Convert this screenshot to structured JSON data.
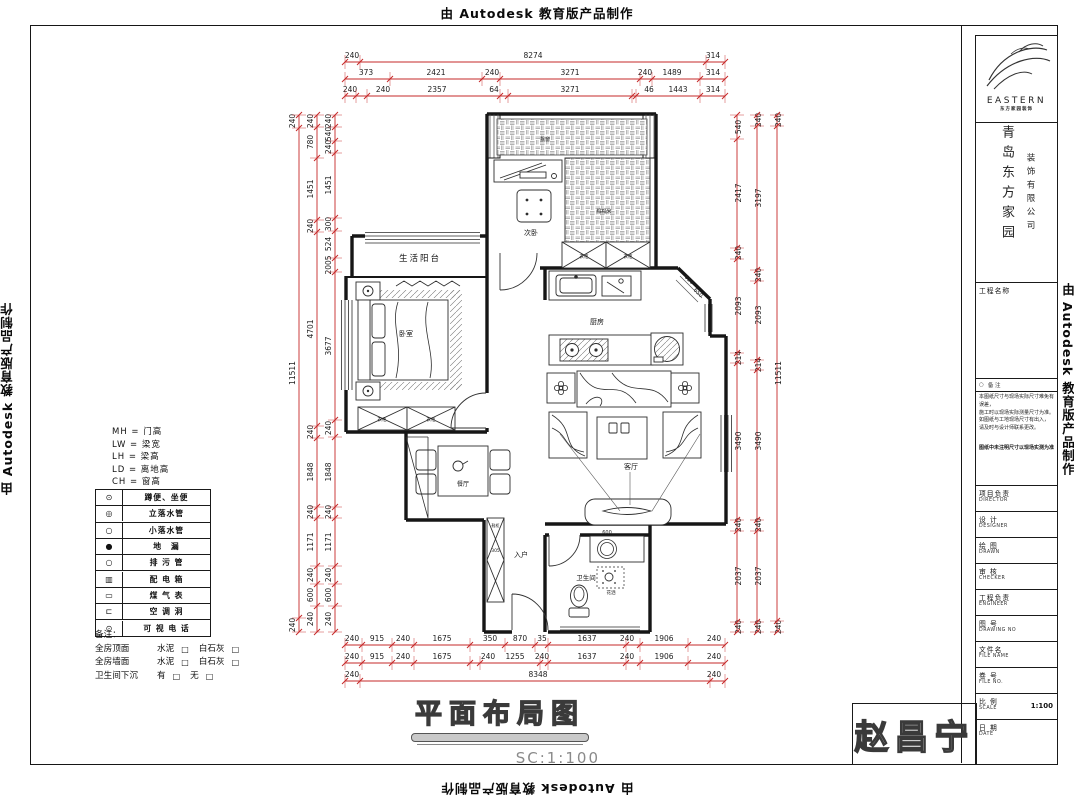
{
  "watermark": {
    "text": "由 Autodesk 教育版产品制作"
  },
  "title": {
    "main": "平面布局图",
    "scale": "SC:1:100"
  },
  "signature": "赵昌宁",
  "colors": {
    "dimension_red": "#c62828",
    "wall_black": "#161616"
  },
  "rooms": {
    "balcony": "生活阳台",
    "second_bedroom": "次卧",
    "master_bedroom": "卧室",
    "kitchen": "厨房",
    "dining": "餐厅",
    "living": "客厅",
    "entry": "入户",
    "bathroom": "卫生间",
    "tatami": "榻榻米",
    "bay_window": "飘窗"
  },
  "furniture": {
    "wardrobe": "衣柜",
    "shoe_cabinet": "鞋柜",
    "shower": "花洒"
  },
  "plan_dims": {
    "basin": "600",
    "shoe_width": "305",
    "chamfer_a": "650",
    "chamfer_b": "650"
  },
  "dims": {
    "top": [
      [
        "240",
        "8274",
        "314"
      ],
      [
        "373",
        "2421",
        "240",
        "3271",
        "240",
        "1489",
        "314"
      ],
      [
        "240",
        "240",
        "2357",
        "64",
        "3271",
        "46",
        "1443",
        "314"
      ]
    ],
    "bottom": [
      [
        "240",
        "915",
        "240",
        "1675",
        "350",
        "870",
        "35",
        "1637",
        "240",
        "1906",
        "240"
      ],
      [
        "240",
        "915",
        "240",
        "1675",
        "240",
        "1255",
        "240",
        "1637",
        "240",
        "1906",
        "240"
      ],
      [
        "240",
        "8348",
        "240"
      ]
    ],
    "left": {
      "outer": [
        "240",
        "11511",
        "240"
      ],
      "middle": [
        "240",
        "780",
        "1451",
        "240",
        "4701",
        "240",
        "1848",
        "240",
        "1171",
        "240",
        "600",
        "240"
      ],
      "inner": [
        "240",
        "540",
        "240",
        "1451",
        "300",
        "524",
        "2005",
        "3677",
        "240",
        "1848",
        "240",
        "1171",
        "240",
        "600",
        "240"
      ]
    },
    "right": {
      "inner": [
        "540",
        "2417",
        "240",
        "2093",
        "214",
        "3490",
        "240",
        "2037",
        "240"
      ],
      "middle": [
        "240",
        "3197",
        "240",
        "2093",
        "214",
        "3490",
        "240",
        "2037",
        "240"
      ],
      "outer": [
        "240",
        "11511",
        "240"
      ]
    }
  },
  "legend": {
    "abbreviations": [
      "MH = 门高",
      "LW = 梁宽",
      "LH = 梁高",
      "LD = 离地高",
      "CH = 窗高"
    ],
    "rows": [
      {
        "symbol": "⊙",
        "label": "蹲便、坐便"
      },
      {
        "symbol": "◎",
        "label": "立落水管"
      },
      {
        "symbol": "○",
        "label": "小落水管"
      },
      {
        "symbol": "●",
        "label": "地　漏"
      },
      {
        "symbol": "○",
        "label": "排 污 管"
      },
      {
        "symbol": "▥",
        "label": "配 电 箱"
      },
      {
        "symbol": "▭",
        "label": "煤 气 表"
      },
      {
        "symbol": "⊏",
        "label": "空 调 洞"
      },
      {
        "symbol": "⊙",
        "label": "可 视 电 话"
      }
    ],
    "notes_title": "备注：",
    "checkbox": "□",
    "notes": [
      {
        "label": "全房顶面",
        "opt1": "水泥",
        "opt2": "白石灰"
      },
      {
        "label": "全房墙面",
        "opt1": "水泥",
        "opt2": "白石灰"
      },
      {
        "label": "卫生间下沉",
        "opt1": "有",
        "opt2": "无"
      }
    ]
  },
  "titleblock": {
    "brand": "EASTERN",
    "brand_sub": "东方家园装饰",
    "company_main": "青岛东方家园",
    "company_sub": "装饰有限公司",
    "project_label": "工程名称",
    "rev_symbol": "○",
    "rev_label": "备 注",
    "disclaimer": [
      "本图纸尺寸与现场实际尺寸难免有误差，",
      "施工时以现场实际测量尺寸为准。",
      "如图纸与工地现场尺寸有出入，",
      "请及时与设计师联系更改。"
    ],
    "site_note": "图纸中未注明尺寸以现场实测为准",
    "rows": [
      {
        "cn": "项目负责",
        "en": "DIRECTOR"
      },
      {
        "cn": "设 计",
        "en": "DESIGNER"
      },
      {
        "cn": "绘 图",
        "en": "DRAWN"
      },
      {
        "cn": "审 核",
        "en": "CHECKER"
      },
      {
        "cn": "工程负责",
        "en": "ENGINEER"
      },
      {
        "cn": "图 号",
        "en": "DRAWING NO"
      },
      {
        "cn": "文件名",
        "en": "FILE NAME"
      },
      {
        "cn": "卷 号",
        "en": "FILE NO."
      },
      {
        "cn": "比 例",
        "en": "SCALE",
        "value": "1:100"
      },
      {
        "cn": "日 期",
        "en": "DATE"
      }
    ]
  }
}
